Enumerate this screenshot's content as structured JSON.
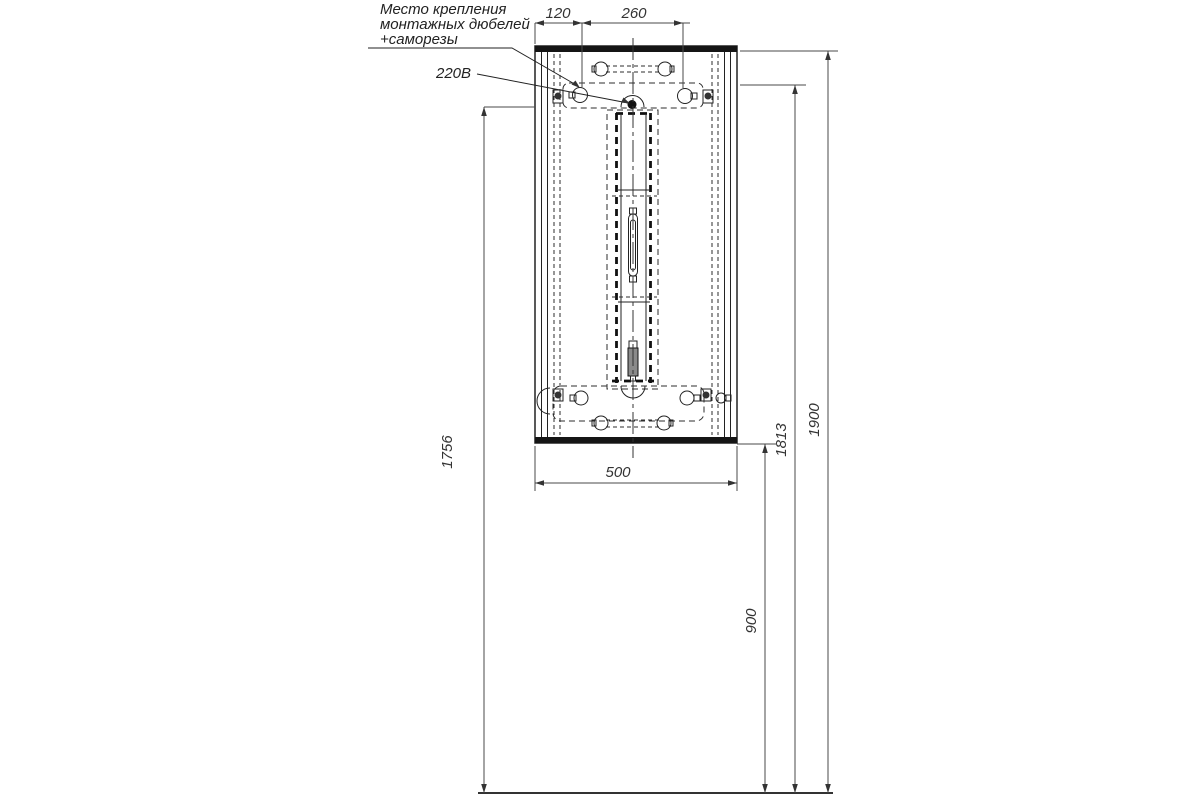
{
  "drawing": {
    "note": {
      "line1": "Место крепления",
      "line2": "монтажных дюбелей",
      "line3": "+саморезы"
    },
    "power_label": "220В",
    "dimensions": {
      "hole_offset_left": "120",
      "hole_spacing": "260",
      "cabinet_width": "500",
      "height_power_point": "1756",
      "height_cabinet_bottom": "900",
      "height_mounting_holes": "1813",
      "height_cabinet_top": "1900"
    },
    "colors": {
      "background": "#ffffff",
      "outline": "#222222",
      "dimension": "#4a4a4a"
    }
  }
}
